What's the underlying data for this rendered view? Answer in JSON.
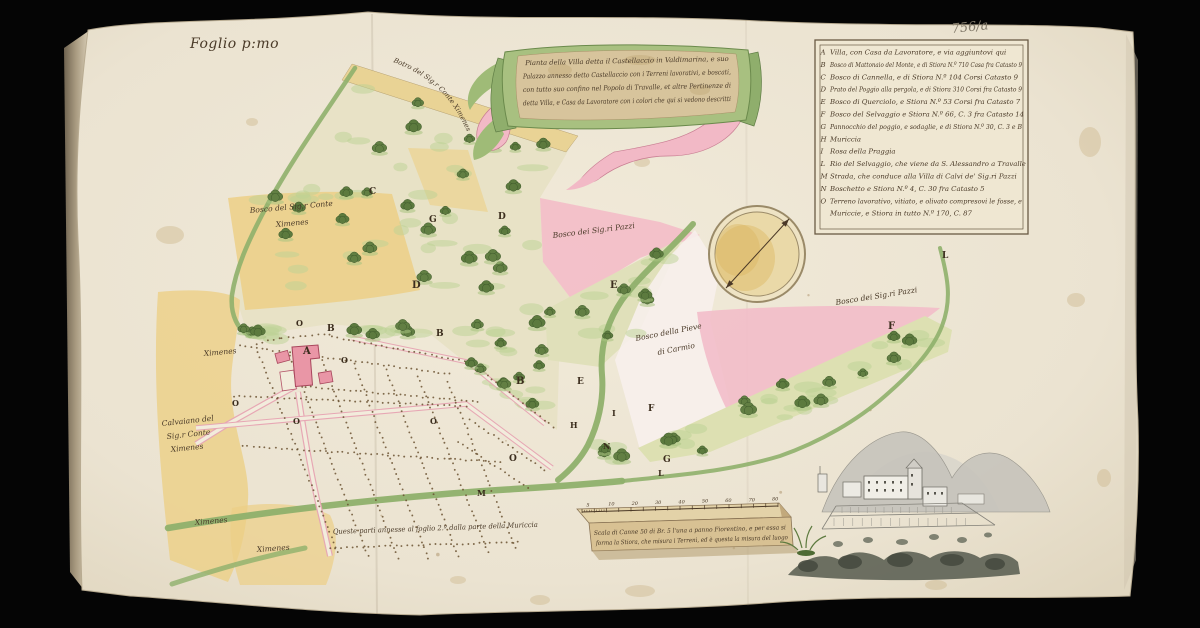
{
  "document": {
    "folio_label": "Foglio p:mo",
    "archive_mark": "756/a",
    "margin_note": "Queste parti annesse al foglio 2.º   dalla parte della Muriccia"
  },
  "cartouche": {
    "lines": [
      "Pianta della Villa detta il Castellaccio in Valdimarina, e suo",
      "Palazzo annesso detto Castellaccio con i Terreni lavorativi, e boscati,",
      "con tutto suo confino nel Popolo di Travalle, et altre Pertinenze di",
      "detta Villa, e Casa da Lavoratore con i colori che qui si vedono descritti"
    ]
  },
  "legend": {
    "items": [
      {
        "key": "A",
        "text": "Villa, con Casa da Lavoratore, e via aggiuntovi qui"
      },
      {
        "key": "B",
        "text": "Bosco di Mattonaio del Monte, e di Stiora N.º 710 Casa fra Catasto 9"
      },
      {
        "key": "C",
        "text": "Bosco di Cannella, e di Stiora N.º 104 Corsi Catasto 9"
      },
      {
        "key": "D",
        "text": "Prato del Poggio alla pergola, e di Stiora 310 Corsi fra Catasto 9"
      },
      {
        "key": "E",
        "text": "Bosco di Querciolo, e Stiora N.º 53 Corsi fra Catasto 7"
      },
      {
        "key": "F",
        "text": "Bosco del Selvaggio e Stiora N.º 66, C. 3 fra Catasto 14"
      },
      {
        "key": "G",
        "text": "Pannocchio del poggio, e sodaglie, e di Stiora N.º 30, C. 3 e B"
      },
      {
        "key": "H",
        "text": "Muriccia"
      },
      {
        "key": "I",
        "text": "Rosa della Praggia"
      },
      {
        "key": "L",
        "text": "Rio del Selvaggio, che viene da S. Alessandro a Travalle"
      },
      {
        "key": "M",
        "text": "Strada, che conduce alla Villa di Calvi de' Sig.ri Pazzi"
      },
      {
        "key": "N",
        "text": "Boschetto e Stiora N.º 4, C. 30 fra Catasto 5"
      },
      {
        "key": "O",
        "text": "Terreno lavorativo, vitiato, e olivato compresovi le fosse, e"
      },
      {
        "key": "",
        "text": "Muriccie, e Stiora in tutto N.º 170, C. 87"
      }
    ]
  },
  "map": {
    "road_label": "Botro del Sig.r Conte Ximenes",
    "labels": [
      {
        "text": "Bosco del Sig.r Conte",
        "x": 250,
        "y": 213,
        "rot": -5
      },
      {
        "text": "Ximenes",
        "x": 276,
        "y": 227,
        "rot": -5
      },
      {
        "text": "Bosco dei Sig.ri Pazzi",
        "x": 553,
        "y": 238,
        "rot": -7
      },
      {
        "text": "Bosco dei Sig.ri Pazzi",
        "x": 836,
        "y": 305,
        "rot": -9
      },
      {
        "text": "Bosco della Pieve",
        "x": 636,
        "y": 341,
        "rot": -11
      },
      {
        "text": "di Carmio",
        "x": 658,
        "y": 355,
        "rot": -11
      },
      {
        "text": "Calvaiano del",
        "x": 162,
        "y": 426,
        "rot": -6
      },
      {
        "text": "Sig.r Conte",
        "x": 167,
        "y": 439,
        "rot": -6
      },
      {
        "text": "Ximenes",
        "x": 171,
        "y": 452,
        "rot": -6
      },
      {
        "text": "Ximenes",
        "x": 204,
        "y": 356,
        "rot": -5
      },
      {
        "text": "Ximenes",
        "x": 195,
        "y": 525,
        "rot": -5
      },
      {
        "text": "Ximenes",
        "x": 257,
        "y": 552,
        "rot": -4
      }
    ],
    "letters": [
      {
        "ch": "A",
        "x": 303,
        "y": 354,
        "size": 10
      },
      {
        "ch": "B",
        "x": 327,
        "y": 331,
        "size": 9
      },
      {
        "ch": "B",
        "x": 436,
        "y": 336,
        "size": 9
      },
      {
        "ch": "B",
        "x": 516,
        "y": 384,
        "size": 10
      },
      {
        "ch": "C",
        "x": 369,
        "y": 194,
        "size": 9
      },
      {
        "ch": "G",
        "x": 429,
        "y": 222,
        "size": 9
      },
      {
        "ch": "D",
        "x": 498,
        "y": 219,
        "size": 9
      },
      {
        "ch": "D",
        "x": 412,
        "y": 288,
        "size": 10
      },
      {
        "ch": "E",
        "x": 610,
        "y": 288,
        "size": 10
      },
      {
        "ch": "E",
        "x": 577,
        "y": 384,
        "size": 9
      },
      {
        "ch": "F",
        "x": 648,
        "y": 411,
        "size": 9
      },
      {
        "ch": "F",
        "x": 888,
        "y": 329,
        "size": 10
      },
      {
        "ch": "G",
        "x": 663,
        "y": 462,
        "size": 9
      },
      {
        "ch": "H",
        "x": 570,
        "y": 428,
        "size": 8
      },
      {
        "ch": "I",
        "x": 612,
        "y": 416,
        "size": 8
      },
      {
        "ch": "L",
        "x": 942,
        "y": 258,
        "size": 9
      },
      {
        "ch": "L",
        "x": 658,
        "y": 476,
        "size": 8
      },
      {
        "ch": "M",
        "x": 477,
        "y": 496,
        "size": 8
      },
      {
        "ch": "N",
        "x": 603,
        "y": 449,
        "size": 8
      },
      {
        "ch": "O",
        "x": 296,
        "y": 326,
        "size": 8
      },
      {
        "ch": "O",
        "x": 341,
        "y": 363,
        "size": 8
      },
      {
        "ch": "O",
        "x": 232,
        "y": 406,
        "size": 8
      },
      {
        "ch": "O",
        "x": 293,
        "y": 424,
        "size": 8
      },
      {
        "ch": "O",
        "x": 430,
        "y": 424,
        "size": 8
      },
      {
        "ch": "O",
        "x": 509,
        "y": 461,
        "size": 9
      }
    ]
  },
  "scale_bar": {
    "ticks": [
      "5",
      "10",
      "20",
      "30",
      "40",
      "50",
      "60",
      "70",
      "80"
    ],
    "caption_lines": [
      "Scala di Canne 50 di Br. 5 l'una a panno Fiorentino, e per essa si",
      "forma la Stiora, che misura i Terreni, ed è questa la misura del luogo"
    ]
  },
  "colors": {
    "paper": "#ebe3d1",
    "woods": "#b8cf92",
    "pink": "#f3bcc8",
    "yellow": "#eccf86",
    "river": "#8fb06b",
    "ink": "#4a3a28"
  }
}
